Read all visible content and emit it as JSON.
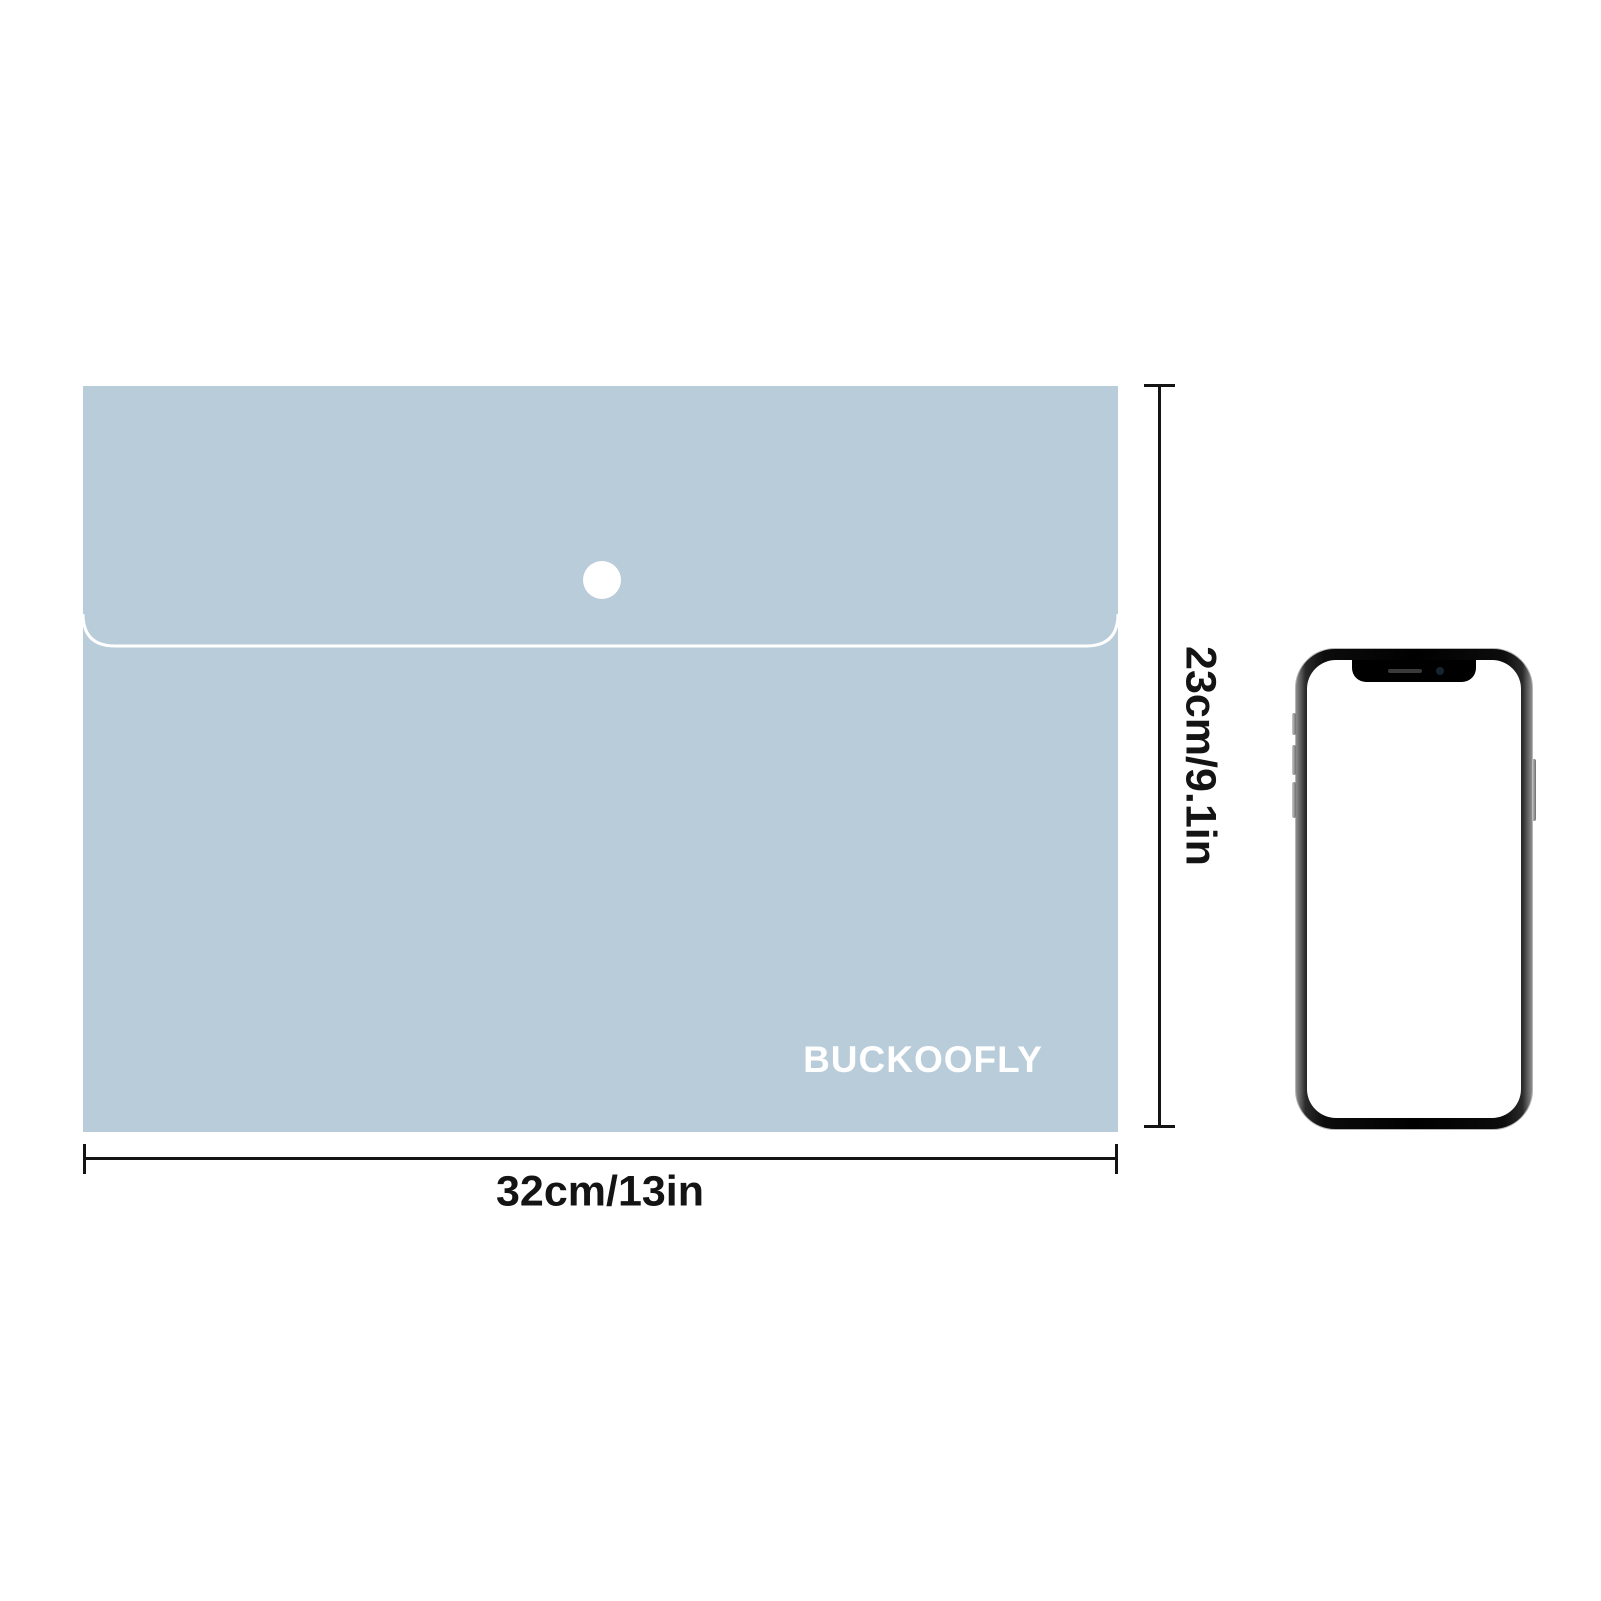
{
  "canvas": {
    "background": "#ffffff"
  },
  "product": {
    "brand_label": "BUCKOOFLY",
    "folder_color": "#b9ccda",
    "flap_line_color": "#ffffff",
    "snap_button_color": "#ffffff"
  },
  "annotations": {
    "width_label": "32cm/13in",
    "height_label": "23cm/9.1in",
    "line_color": "#141414",
    "text_color": "#141414"
  },
  "reference_object": {
    "type": "smartphone",
    "frame_color": "#1b1b1b",
    "screen_color": "#ffffff"
  }
}
